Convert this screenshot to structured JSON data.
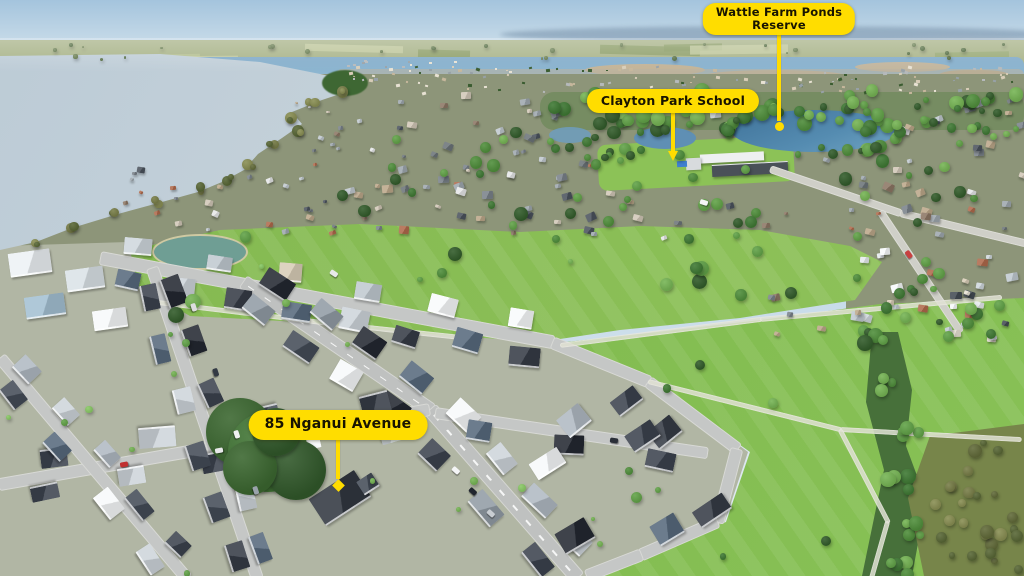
{
  "image_type": "annotated-aerial-photograph",
  "annotations": [
    {
      "id": "wattle-farm-ponds-reserve",
      "text": "Wattle Farm Ponds\nReserve",
      "anchor_x": 779,
      "box_top": 3,
      "leader_end_y": 121,
      "tip": "circle"
    },
    {
      "id": "clayton-park-school",
      "text": "Clayton Park School",
      "anchor_x": 673,
      "box_top": 89,
      "leader_end_y": 152,
      "tip": "arrow"
    },
    {
      "id": "85-nganui-avenue",
      "text": "85 Nganui Avenue",
      "anchor_x": 338,
      "box_top": 410,
      "leader_end_y": 479,
      "tip": "diamond"
    }
  ],
  "colors": {
    "label_bg": "#ffdd00",
    "label_text": "#181400",
    "leader": "#ffdc00"
  }
}
